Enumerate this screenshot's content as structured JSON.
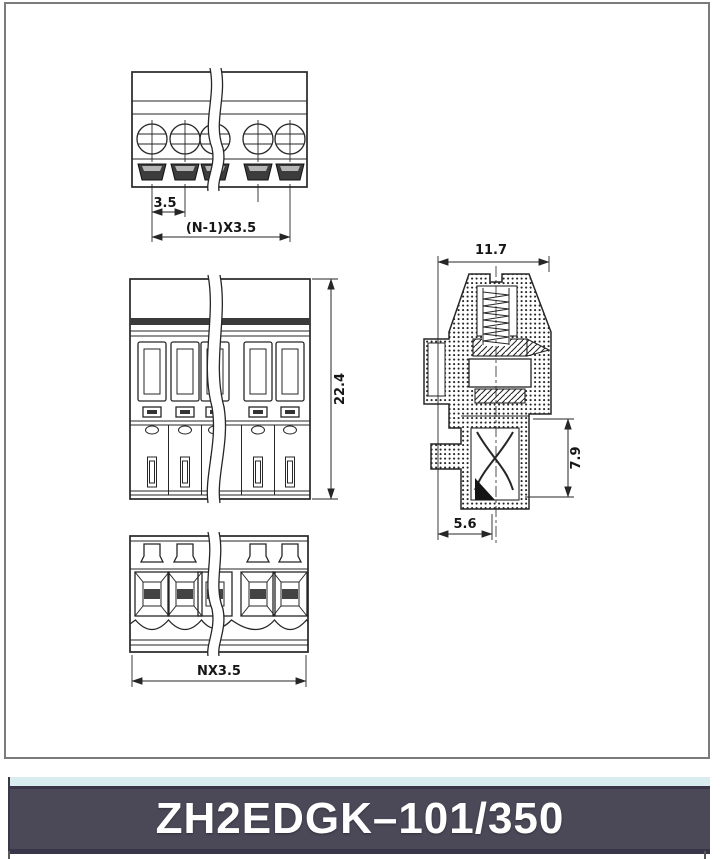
{
  "drawing": {
    "top_view": {
      "pitch": "3.5",
      "total_pitch": "(N-1)X3.5"
    },
    "front_view": {
      "height": "22.4"
    },
    "bottom_view": {
      "total_width": "NX3.5"
    },
    "section_view": {
      "width": "11.7",
      "depth": "7.9",
      "bottom_width": "5.6"
    }
  },
  "banner": {
    "model": "ZH2EDGK–101/350"
  },
  "colors": {
    "banner_bg": "#4b4858",
    "banner_strip": "#d9edf1",
    "banner_border": "#393649",
    "line": "#262626",
    "sheet_border": "#7b7b7b"
  }
}
